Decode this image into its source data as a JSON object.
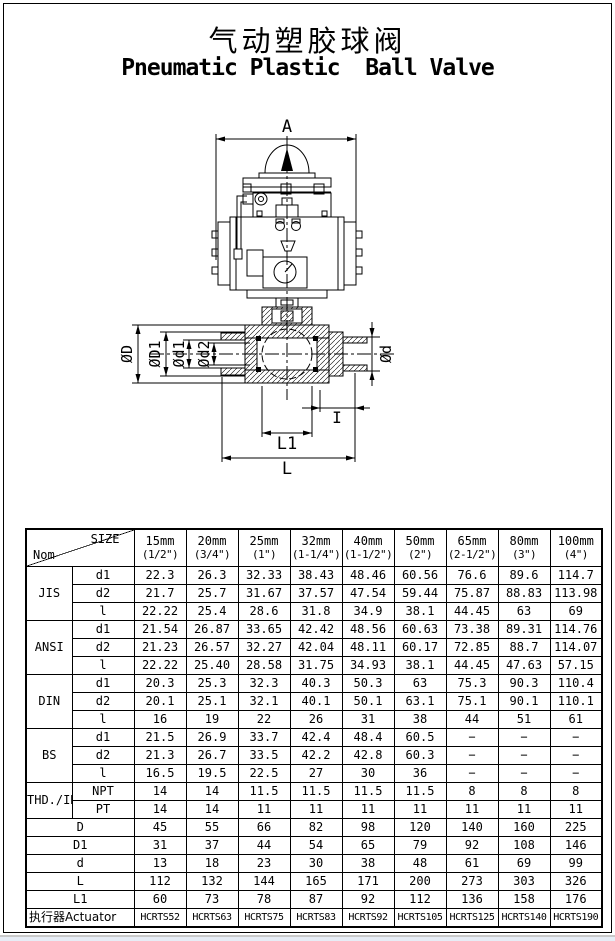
{
  "page": {
    "title_zh": "气动塑胶球阀",
    "title_en": "Pneumatic Plastic  Ball Valve"
  },
  "drawing": {
    "dim_a": "A",
    "dim_D": "ØD",
    "dim_D1": "ØD1",
    "dim_d1": "Ød1",
    "dim_d2": "Ød2",
    "dim_d": "Ød",
    "dim_i": "I",
    "dim_l1": "L1",
    "dim_l": "L"
  },
  "table": {
    "size_label": "SIZE",
    "nom_label": "Nom",
    "columns": [
      {
        "mm": "15mm",
        "inch": "(1/2\")"
      },
      {
        "mm": "20mm",
        "inch": "(3/4\")"
      },
      {
        "mm": "25mm",
        "inch": "(1\")"
      },
      {
        "mm": "32mm",
        "inch": "(1-1/4\")"
      },
      {
        "mm": "40mm",
        "inch": "(1-1/2\")"
      },
      {
        "mm": "50mm",
        "inch": "(2\")"
      },
      {
        "mm": "65mm",
        "inch": "(2-1/2\")"
      },
      {
        "mm": "80mm",
        "inch": "(3\")"
      },
      {
        "mm": "100mm",
        "inch": "(4\")"
      }
    ],
    "groups": [
      {
        "name": "JIS",
        "rows": [
          {
            "label": "d1",
            "values": [
              "22.3",
              "26.3",
              "32.33",
              "38.43",
              "48.46",
              "60.56",
              "76.6",
              "89.6",
              "114.7"
            ]
          },
          {
            "label": "d2",
            "values": [
              "21.7",
              "25.7",
              "31.67",
              "37.57",
              "47.54",
              "59.44",
              "75.87",
              "88.83",
              "113.98"
            ]
          },
          {
            "label": "l",
            "values": [
              "22.22",
              "25.4",
              "28.6",
              "31.8",
              "34.9",
              "38.1",
              "44.45",
              "63",
              "69"
            ]
          }
        ]
      },
      {
        "name": "ANSI",
        "rows": [
          {
            "label": "d1",
            "values": [
              "21.54",
              "26.87",
              "33.65",
              "42.42",
              "48.56",
              "60.63",
              "73.38",
              "89.31",
              "114.76"
            ]
          },
          {
            "label": "d2",
            "values": [
              "21.23",
              "26.57",
              "32.27",
              "42.04",
              "48.11",
              "60.17",
              "72.85",
              "88.7",
              "114.07"
            ]
          },
          {
            "label": "l",
            "values": [
              "22.22",
              "25.40",
              "28.58",
              "31.75",
              "34.93",
              "38.1",
              "44.45",
              "47.63",
              "57.15"
            ]
          }
        ]
      },
      {
        "name": "DIN",
        "rows": [
          {
            "label": "d1",
            "values": [
              "20.3",
              "25.3",
              "32.3",
              "40.3",
              "50.3",
              "63",
              "75.3",
              "90.3",
              "110.4"
            ]
          },
          {
            "label": "d2",
            "values": [
              "20.1",
              "25.1",
              "32.1",
              "40.1",
              "50.1",
              "63.1",
              "75.1",
              "90.1",
              "110.1"
            ]
          },
          {
            "label": "l",
            "values": [
              "16",
              "19",
              "22",
              "26",
              "31",
              "38",
              "44",
              "51",
              "61"
            ]
          }
        ]
      },
      {
        "name": "BS",
        "rows": [
          {
            "label": "d1",
            "values": [
              "21.5",
              "26.9",
              "33.7",
              "42.4",
              "48.4",
              "60.5",
              "−",
              "−",
              "−"
            ]
          },
          {
            "label": "d2",
            "values": [
              "21.3",
              "26.7",
              "33.5",
              "42.2",
              "42.8",
              "60.3",
              "−",
              "−",
              "−"
            ]
          },
          {
            "label": "l",
            "values": [
              "16.5",
              "19.5",
              "22.5",
              "27",
              "30",
              "36",
              "−",
              "−",
              "−"
            ]
          }
        ]
      },
      {
        "name": "THD./IN",
        "rows": [
          {
            "label": "NPT",
            "values": [
              "14",
              "14",
              "11.5",
              "11.5",
              "11.5",
              "11.5",
              "8",
              "8",
              "8"
            ]
          },
          {
            "label": "PT",
            "values": [
              "14",
              "14",
              "11",
              "11",
              "11",
              "11",
              "11",
              "11",
              "11"
            ]
          }
        ]
      }
    ],
    "span_rows": [
      {
        "label": "D",
        "values": [
          "45",
          "55",
          "66",
          "82",
          "98",
          "120",
          "140",
          "160",
          "225"
        ]
      },
      {
        "label": "D1",
        "values": [
          "31",
          "37",
          "44",
          "54",
          "65",
          "79",
          "92",
          "108",
          "146"
        ]
      },
      {
        "label": "d",
        "values": [
          "13",
          "18",
          "23",
          "30",
          "38",
          "48",
          "61",
          "69",
          "99"
        ]
      },
      {
        "label": "L",
        "values": [
          "112",
          "132",
          "144",
          "165",
          "171",
          "200",
          "273",
          "303",
          "326"
        ]
      },
      {
        "label": "L1",
        "values": [
          "60",
          "73",
          "78",
          "87",
          "92",
          "112",
          "136",
          "158",
          "176"
        ]
      }
    ],
    "actuator_row": {
      "label": "执行器Actuator",
      "values": [
        "HCRTS52",
        "HCRTS63",
        "HCRTS75",
        "HCRTS83",
        "HCRTS92",
        "HCRTS105",
        "HCRTS125",
        "HCRTS140",
        "HCRTS190"
      ]
    }
  }
}
